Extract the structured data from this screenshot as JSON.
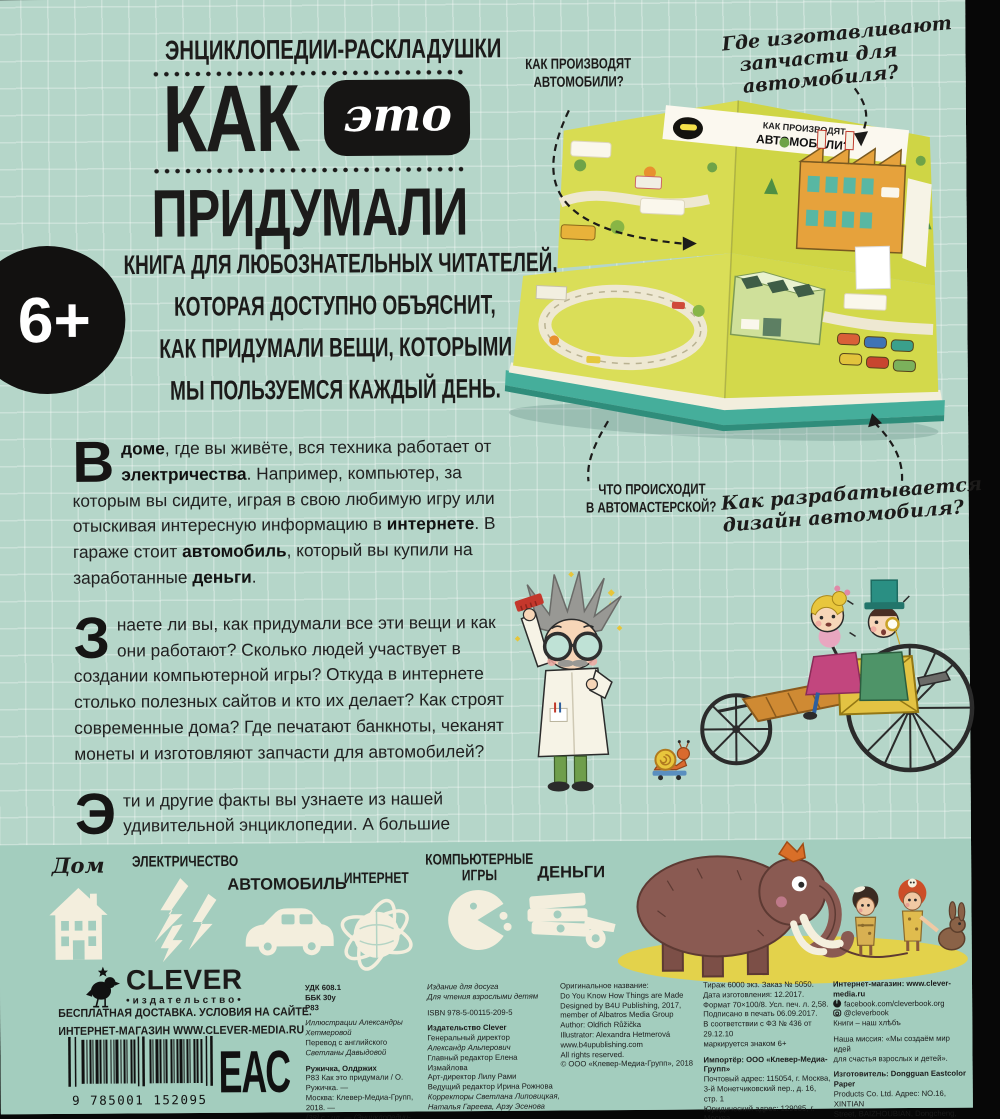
{
  "colors": {
    "background_teal": "#b5d6c9",
    "band_teal": "#a3cdbe",
    "accent_black": "#161514",
    "map_yellow": "#d7db4f",
    "cream": "#f3eedd"
  },
  "cover": {
    "series_title": "ЭНЦИКЛОПЕДИИ-РАСКЛАДУШКИ",
    "title_kak": "КАК",
    "title_eto": "это",
    "title_pridumali": "ПРИДУМАЛИ",
    "age_badge": "6+",
    "tagline_lines": [
      "КНИГА ДЛЯ ЛЮБОЗНАТЕЛЬНЫХ ЧИТАТЕЛЕЙ,",
      "КОТОРАЯ ДОСТУПНО ОБЪЯСНИТ,",
      "КАК ПРИДУМАЛИ ВЕЩИ, КОТОРЫМИ",
      "МЫ ПОЛЬЗУЕМСЯ КАЖДЫЙ ДЕНЬ."
    ],
    "paragraphs": [
      {
        "dropcap": "В",
        "segments": [
          {
            "t": " "
          },
          {
            "t": "доме",
            "b": true
          },
          {
            "t": ", где вы живёте, вся техника работает от "
          },
          {
            "t": "электричества",
            "b": true
          },
          {
            "t": ". Например, компьютер, за которым вы сидите, играя в свою любимую игру или отыскивая интересную информацию в "
          },
          {
            "t": "интернете",
            "b": true
          },
          {
            "t": ". В гараже стоит "
          },
          {
            "t": "автомобиль",
            "b": true
          },
          {
            "t": ", который вы купили на заработанные "
          },
          {
            "t": "деньги",
            "b": true
          },
          {
            "t": "."
          }
        ]
      },
      {
        "dropcap": "З",
        "segments": [
          {
            "t": "наете ли вы, как придумали все эти вещи и как они работают? Сколько людей участвует в создании компьютерной игры? Откуда в интернете столько полезных сайтов и кто их делает? Как строят современные дома? Где печатают банкноты, чеканят монеты и изготовляют запчасти для автомобилей?"
          }
        ]
      },
      {
        "dropcap": "Э",
        "segments": [
          {
            "t": "ти и другие факты вы узнаете из нашей удивительной энциклопедии. А большие развороты и брошюры с дополнительной информацией сделают чтение весёлым и увлекательным."
          }
        ]
      }
    ]
  },
  "annotations": {
    "top_left_l1": "КАК ПРОИЗВОДЯТ",
    "top_left_l2": "АВТОМОБИЛИ?",
    "top_right_l1": "Где изготавливают",
    "top_right_l2": "запчасти для",
    "top_right_l3": "автомобиля?",
    "bottom_left_l1": "ЧТО ПРОИСХОДИТ",
    "bottom_left_l2": "В АВТОМАСТЕРСКОЙ?",
    "bottom_right_l1": "Как разрабатывается",
    "bottom_right_l2": "дизайн автомобиля?"
  },
  "book_preview": {
    "banner_l1": "КАК ПРОИЗВОДЯТ",
    "banner_l2": "АВТОМОБИЛИ?"
  },
  "categories": {
    "home": "Дом",
    "electricity": "ЭЛЕКТРИЧЕСТВО",
    "car": "АВТОМОБИЛЬ",
    "internet": "ИНТЕРНЕТ",
    "games_line1": "КОМПЬЮТЕРНЫЕ",
    "games_line2": "ИГРЫ",
    "money": "ДЕНЬГИ"
  },
  "footer": {
    "logo_text": "CLEVER",
    "logo_sub": "•издательство•",
    "shipping_l1": "БЕСПЛАТНАЯ ДОСТАВКА. УСЛОВИЯ НА САЙТЕ.",
    "shipping_l2": "ИНТЕРНЕТ-МАГАЗИН WWW.CLEVER-MEDIA.RU",
    "barcode_digits": "9 785001 152095",
    "eac": "ЕАС",
    "cols": [
      {
        "lines": [
          {
            "t": "УДК 608.1",
            "b": true
          },
          {
            "t": "ББК 30у",
            "b": true
          },
          {
            "t": "Р83",
            "b": true
          },
          {
            "t": "Иллюстрации Александры Хетмеровой",
            "i": true,
            "gap": true
          },
          {
            "t": "Перевод с английского"
          },
          {
            "t": "Светланы Давыдовой",
            "i": true
          },
          {
            "t": "Ружичка, Олдржих",
            "b": true,
            "gap": true
          },
          {
            "t": "Р83  Как это придумали / О. Ружичка. —"
          },
          {
            "t": "Москва: Клевер-Медиа-Групп, 2018. —"
          },
          {
            "t": "[38] с.: ил. — (Энциклопедии-раскладушки)",
            "i": true
          }
        ]
      },
      {
        "lines": [
          {
            "t": "Издание для досуга",
            "i": true
          },
          {
            "t": "Для чтения взрослыми детям",
            "i": true
          },
          {
            "t": "ISBN 978-5-00115-209-5",
            "gap": true
          },
          {
            "t": "Издательство Clever",
            "b": true,
            "gap": true
          },
          {
            "t": "Генеральный директор"
          },
          {
            "t": "Александр Альперович",
            "i": true
          },
          {
            "t": "Главный редактор Елена Измайлова"
          },
          {
            "t": "Арт-директор Лилу Рами"
          },
          {
            "t": "Ведущий редактор Ирина Рожнова"
          },
          {
            "t": "Корректоры Светлана Липовицкая,",
            "i": true
          },
          {
            "t": "Наталья Гареева, Арзу Эсенова",
            "i": true
          }
        ]
      },
      {
        "lines": [
          {
            "t": "Оригинальное название:"
          },
          {
            "t": "Do You Know How Things are Made"
          },
          {
            "t": "Designed by B4U Publishing, 2017,"
          },
          {
            "t": "member of Albatros Media Group"
          },
          {
            "t": "Author: Oldřich Růžička"
          },
          {
            "t": "Illustrator: Alexandra Hetmerová"
          },
          {
            "t": "www.b4upublishing.com"
          },
          {
            "t": "All rights reserved."
          },
          {
            "t": "© ООО «Клевер-Медиа-Групп», 2018"
          }
        ]
      },
      {
        "lines": [
          {
            "t": "Тираж 6000 экз.  Заказ № 5050."
          },
          {
            "t": "Дата изготовления: 12.2017."
          },
          {
            "t": "Формат 70×100/8. Усл. печ. л. 2,58."
          },
          {
            "t": "Подписано в печать 06.09.2017."
          },
          {
            "t": "В соответствии с ФЗ № 436 от 29.12.10"
          },
          {
            "t": "маркируется знаком 6+"
          },
          {
            "t": "Импортёр: ООО «Клевер-Медиа-Групп»",
            "b": true,
            "gap": true
          },
          {
            "t": "Почтовый адрес: 115054, г. Москва,"
          },
          {
            "t": "3-й Монетчиковский пер., д. 16, стр. 1"
          },
          {
            "t": "Юридический адрес: 129085, г. Москва,"
          },
          {
            "t": "проезд Ольминского, д. 3а, стр. 3"
          }
        ]
      },
      {
        "lines": [
          {
            "t": "Интернет-магазин: www.clever-media.ru",
            "b": true
          },
          {
            "t": "facebook.com/cleverbook.org",
            "icon": "fb"
          },
          {
            "t": "@cleverbook",
            "icon": "ig"
          },
          {
            "t": "Книги – наш хлѣбъ"
          },
          {
            "t": "Наша миссия: «Мы создаём мир идей",
            "gap": true
          },
          {
            "t": "для счастья взрослых и детей»."
          },
          {
            "t": "Изготовитель: Dongguan Eastcolor Paper",
            "b": true,
            "gap": true
          },
          {
            "t": "Products Co. Ltd. Адрес: NO.16, XINTIAN"
          },
          {
            "t": "Street, BAIZHOUBIAN, Dongcheng,"
          },
          {
            "t": "Dongguan city, Guangdong 523116, China"
          }
        ]
      }
    ]
  }
}
